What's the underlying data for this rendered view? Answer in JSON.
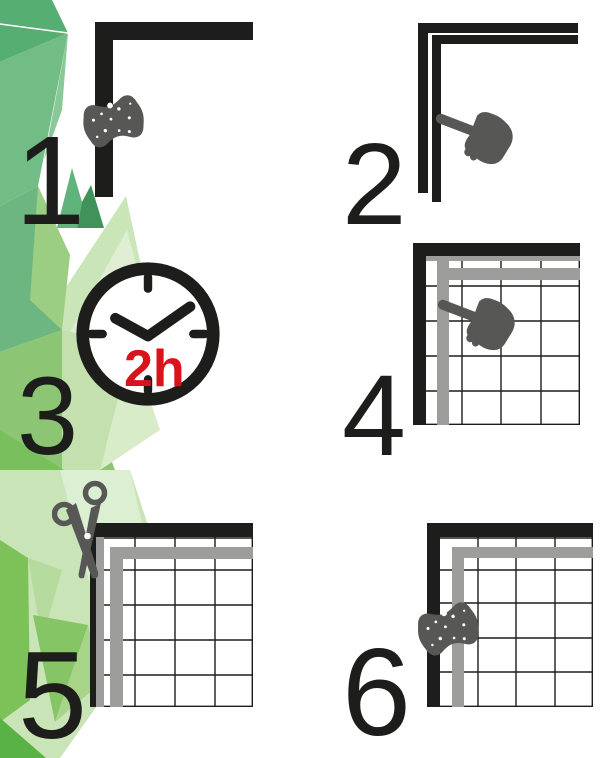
{
  "steps": [
    {
      "number": "1",
      "icon": "sponge-icon"
    },
    {
      "number": "2",
      "icon": "pointing-hand-icon"
    },
    {
      "number": "3",
      "icon": "clock-icon",
      "label": "2h"
    },
    {
      "number": "4",
      "icon": "pointing-hand-icon"
    },
    {
      "number": "5",
      "icon": "scissors-icon"
    },
    {
      "number": "6",
      "icon": "sponge-icon"
    }
  ],
  "colors": {
    "line_black": "#1d1d1b",
    "icon_gray": "#575756",
    "tile_edge_gray": "#9d9d9c",
    "accent_red": "#d9131c",
    "green_facets": [
      "#57ae73",
      "#72bc86",
      "#8ac898",
      "#40925a",
      "#9bcd83",
      "#8cc674",
      "#c9e4b7",
      "#dfeed2",
      "#79bf5b",
      "#86c566",
      "#a8d489",
      "#7dc159",
      "#58b245",
      "#b5da9e",
      "#cae5b8"
    ]
  }
}
